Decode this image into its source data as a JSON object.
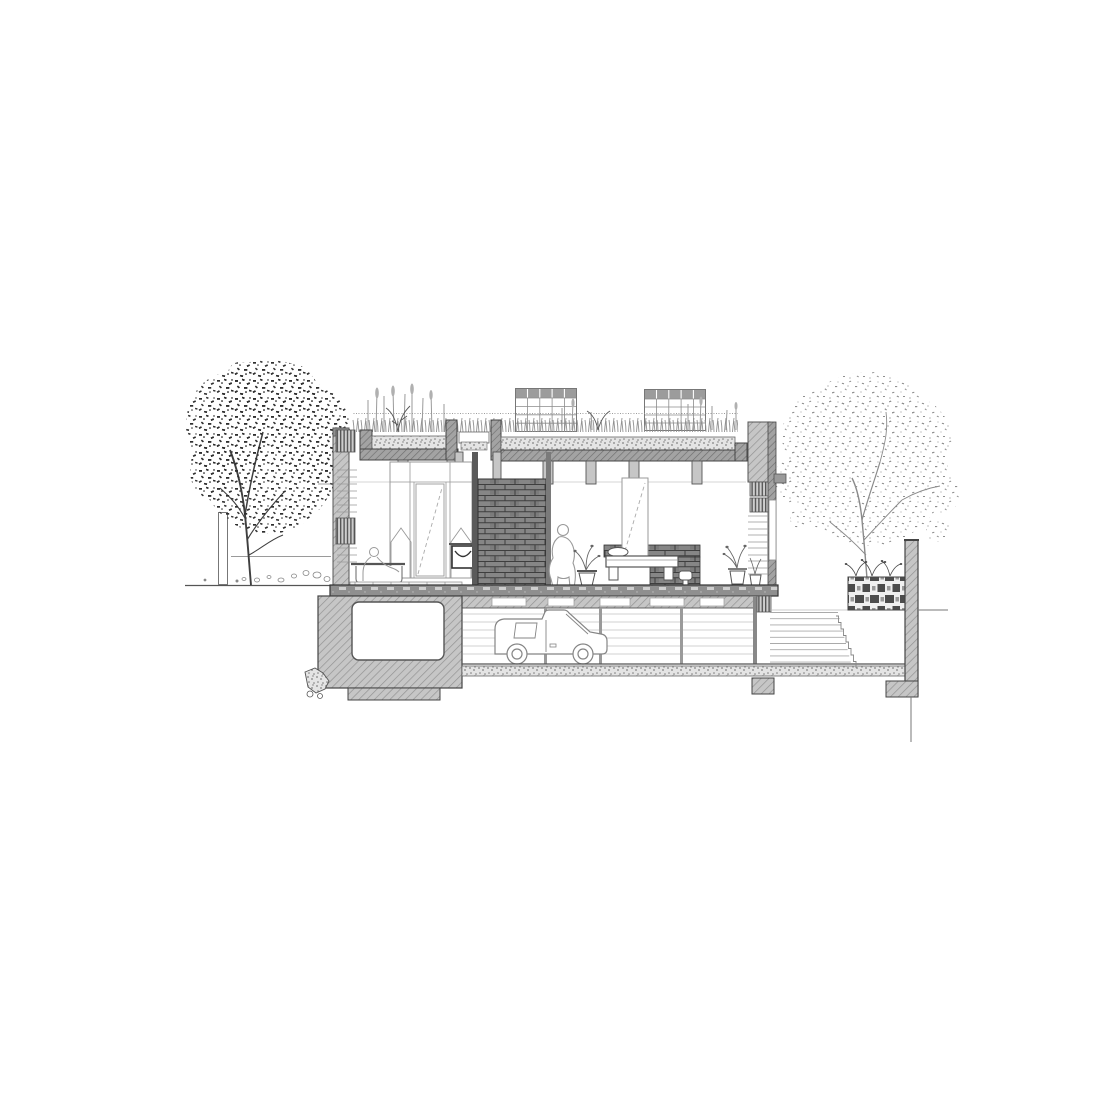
{
  "drawing": {
    "description": "black-and-white architectural cross-section of a house with green roof, two rooflights, bathroom and bedroom at ground floor, basement garage with a van, flanked by two trees, an external stair, a perforated brick screen wall and a boundary retaining wall",
    "visible_counts": {
      "trees": 2,
      "rooflights": 2,
      "human_figures": 2,
      "vehicles": 1,
      "potted_plants": 3,
      "stairs": 3
    },
    "elements": [
      "left-tree",
      "right-tree",
      "green-roof",
      "roof-plants",
      "rooflight",
      "parapet",
      "bathroom-tub",
      "person-in-bath",
      "wardrobe",
      "wash-basin",
      "brick-feature-wall",
      "standing-person",
      "bed",
      "headboard-shelving",
      "potted-plant",
      "internal-stair",
      "ground-floor-slab",
      "basement-garage",
      "van",
      "storage-void",
      "rubble",
      "external-stair",
      "perforated-brick-screen",
      "boundary-wall",
      "ground-line",
      "bollard",
      "pebbles"
    ],
    "palette": {
      "background": "#ffffff",
      "line": "#4a4a4a",
      "cut_wall_fill": "#c6c6c6",
      "dark_wall_fill": "#a3a3a3",
      "brick_dark": "#868686",
      "foliage_dark": "#2f2f2f",
      "foliage_light": "#8f8f8f",
      "slab": "#8f8f8f"
    }
  }
}
